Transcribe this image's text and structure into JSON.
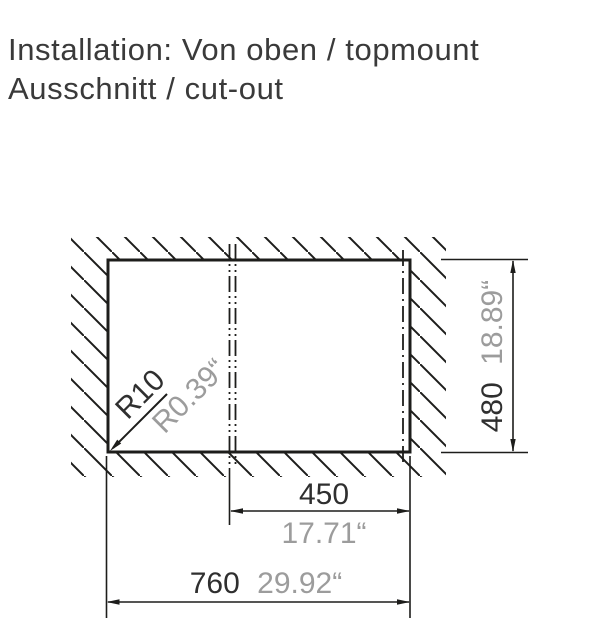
{
  "title": {
    "line1": "Installation: Von oben / topmount",
    "line2": "Ausschnitt / cut-out"
  },
  "dimensions": {
    "corner_radius": {
      "mm": "R10",
      "inch": "R0.39“"
    },
    "drain_offset": {
      "mm": "450",
      "inch": "17.71“"
    },
    "cutout_width": {
      "mm": "760",
      "inch": "29.92“"
    },
    "cutout_height": {
      "mm": "480",
      "inch": "18.89“"
    }
  },
  "colors": {
    "line": "#1d1d1b",
    "primary_text": "#3a3a3a",
    "secondary_text": "#9c9c9c"
  }
}
